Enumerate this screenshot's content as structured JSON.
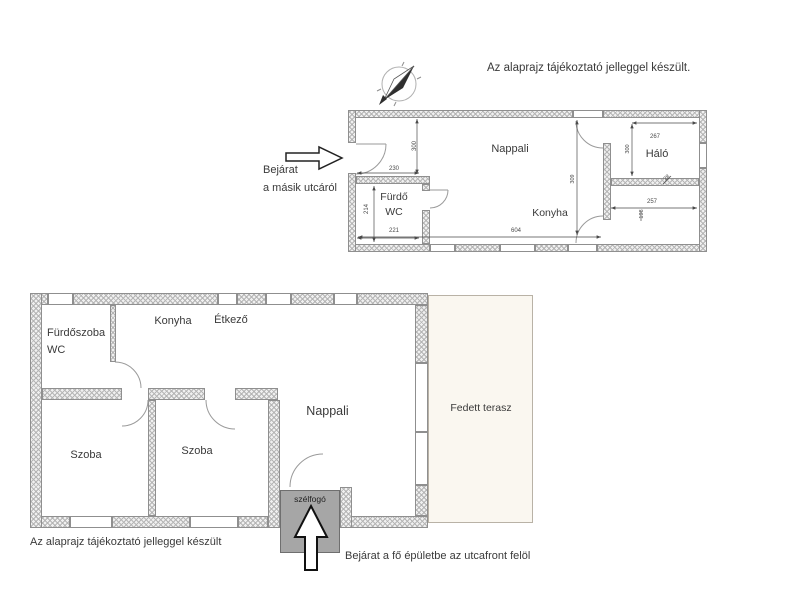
{
  "notes": {
    "upper": "Az alaprajz tájékoztató jelleggel készült.",
    "lower": "Az alaprajz tájékoztató jelleggel készült",
    "upper_entrance_line1": "Bejárat",
    "upper_entrance_line2": "a másik utcáról",
    "lower_entrance": "Bejárat a fő épületbe az utcafront felöl"
  },
  "upper_plan": {
    "rooms": {
      "nappali": "Nappali",
      "konyha": "Konyha",
      "furdo": "Fürdő",
      "wc": "WC",
      "halo": "Háló"
    },
    "dims": {
      "w230": "230",
      "h300": "300",
      "w221": "221",
      "h214": "214",
      "w604": "604",
      "h309": "309",
      "w267": "267",
      "h300b": "300",
      "t28": "28",
      "w257": "257",
      "h198": "198"
    }
  },
  "lower_plan": {
    "rooms": {
      "furdoszoba": "Fürdőszoba",
      "wc": "WC",
      "konyha": "Konyha",
      "etkezo": "Étkező",
      "nappali": "Nappali",
      "szoba1": "Szoba",
      "szoba2": "Szoba",
      "terasz": "Fedett terasz",
      "szelfogo": "szélfogó"
    }
  },
  "colors": {
    "hatch": "#b5b5b5",
    "wall_fill": "#f0f0f0",
    "wall_line": "#8f8f8f",
    "terrace_fill": "#faf7f0",
    "szelfogo_fill": "#a6a6a6",
    "ink": "#3a3a3a",
    "dim_ink": "#4a4a4a"
  }
}
